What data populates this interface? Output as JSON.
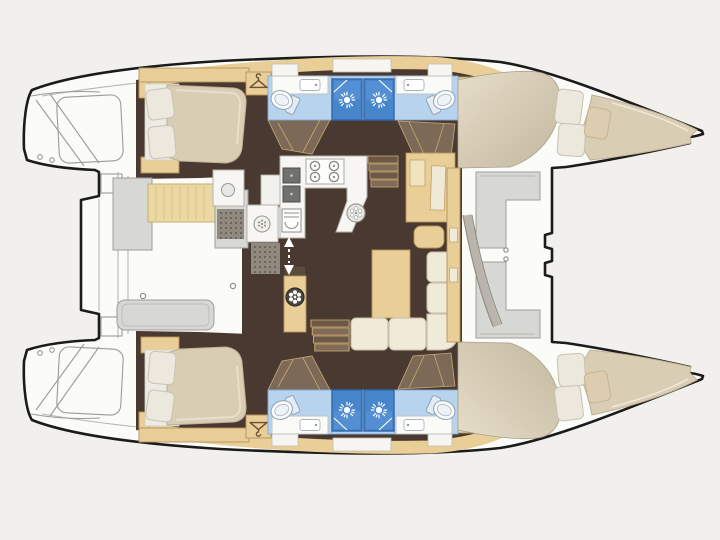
{
  "window": {
    "width": 720,
    "height": 540,
    "title": "Catamaran deck layout plan"
  },
  "diagram": {
    "type": "boat-floor-plan",
    "vessel": "catamaran",
    "orientation": {
      "bow": "right",
      "stern": "left",
      "mirror_axis_y": 255
    },
    "cabins_count": 4,
    "heads_count": 4,
    "areas": {
      "port_hull": {
        "transom": "swim steps and stern platform",
        "aft_cabin": {
          "furniture": [
            "double-berth",
            "two-pillows",
            "headboard-shelf"
          ]
        },
        "aft_head": {
          "fixtures": [
            "shower",
            "toilet",
            "sink"
          ]
        },
        "wardrobe_aft": {
          "icon": "hanger-icon"
        },
        "forward_head": {
          "fixtures": [
            "shower",
            "toilet",
            "sink"
          ]
        },
        "wardrobe_forward": {
          "icon": "hanger-icon"
        },
        "forward_cabin": {
          "furniture": [
            "double-berth",
            "pillows",
            "bow-deck-wedge"
          ]
        }
      },
      "starboard_hull": {
        "mirror_of": "port_hull"
      },
      "cockpit": {
        "furniture": [
          "bench-seat",
          "side-console",
          "cockpit-table",
          "galley-module",
          "drain-mats"
        ]
      },
      "salon": {
        "galley": {
          "fixtures": [
            "four-burner-stove",
            "double-sink",
            "oven",
            "round-sink"
          ]
        },
        "chart_table": {
          "furniture": [
            "desk",
            "seat"
          ]
        },
        "dinette": {
          "furniture": [
            "u-shaped-sofa",
            "dining-table"
          ]
        },
        "mast_post": {
          "icon": "wheel-icon"
        },
        "companionway_steps": 2,
        "companionway_arrow": {
          "icon": "up-down-arrow-icon"
        }
      },
      "foredeck": {
        "furniture": [
          "windshield-coachroof",
          "forward-seats",
          "center-walkway"
        ]
      }
    },
    "icons": [
      "shower-sun-icon",
      "hanger-icon",
      "stove-burner-icon",
      "toilet-icon",
      "sink-basin-icon",
      "round-sink-icon",
      "wheel-icon",
      "grill-icon",
      "washer-icon",
      "steps-icon",
      "up-down-arrow-icon",
      "deck-ring-icon"
    ]
  },
  "colors": {
    "background": "#f1f0ec",
    "deck_white": "#fbfbf8",
    "outline_black": "#1b1b1b",
    "detail_gray": "#b7b7b2",
    "furniture_gray": "#d7d7d3",
    "furniture_gray_border": "#9e9e99",
    "floor_dark_brown": "#4a3931",
    "corridor_brown": "#7d6957",
    "wood_tan": "#e9cf97",
    "wood_tan_border": "#b2925d",
    "bath_floor_blue": "#b7d3ee",
    "bath_blue_border": "#7fa9d2",
    "shower_blue": "#4886cb",
    "shower_blue_dark": "#2f66a8",
    "shower_blue_light": "#5d97d8",
    "mattress_cream": "#d9cdb4",
    "linen_white": "#ece8dd",
    "sofa_cream": "#f0ead9",
    "sofa_border": "#c7bfa8",
    "bench_tan": "#ecd8a3",
    "counter_white": "#f7f6f2",
    "counter_border": "#b5b2aa",
    "steel_gray": "#70706c",
    "mat_gray": "#908a7e",
    "mat_dot": "#4f493f",
    "windshield_cream": "#ddd2bc",
    "windshield_shadow": "#c3b79e"
  }
}
